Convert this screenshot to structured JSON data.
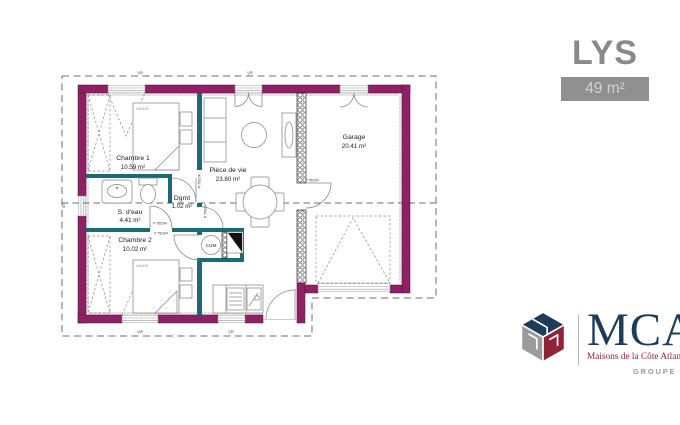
{
  "header": {
    "title": "LYS",
    "area": "49 m²"
  },
  "rooms": {
    "chambre1": {
      "name": "Chambre 1",
      "area": "10.59 m²"
    },
    "sdeau": {
      "name": "S. d'eau",
      "area": "4.41 m²"
    },
    "chambre2": {
      "name": "Chambre 2",
      "area": "10.02 m²"
    },
    "degagement": {
      "name": "Dgmt",
      "area": "1.02 m²"
    },
    "piece_de_vie": {
      "name": "Pièce de vie",
      "area": "23.80 m²"
    },
    "garage": {
      "name": "Garage",
      "area": "20.41 m²"
    }
  },
  "annotations": {
    "door_label": "P 75/204",
    "water_heater": "CUM",
    "bed_dimensions": "140x190",
    "roller_shutter": "VR",
    "small_window_width": "60"
  },
  "branding": {
    "initials": "MCA",
    "tagline": "Maisons de la Côte Atlantique",
    "group": "GROUPE HEXAOM"
  },
  "colors": {
    "exterior_wall": "#8f2066",
    "partition_wall": "#1a6b75",
    "title": "#8a8a8a",
    "badge_bg": "#909090",
    "badge_text": "#d2d2d2",
    "logo_navy": "#1d3c59",
    "logo_red": "#8e2438",
    "logo_gray": "#9b9b9b"
  }
}
